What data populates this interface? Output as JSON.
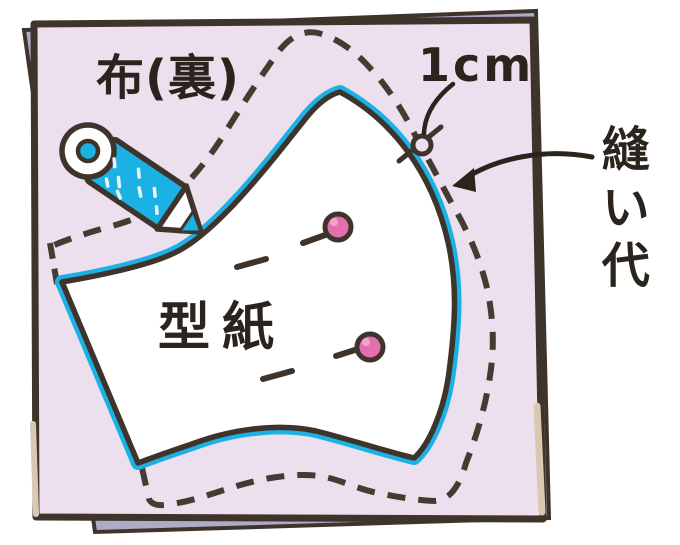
{
  "illustration": {
    "title": "mask sewing pattern diagram",
    "labels": {
      "fabric": "布(裏)",
      "seam_width": "1cm",
      "seam_allowance": "縫い代",
      "pattern": "型紙"
    },
    "colors": {
      "fabric": "#ecdfee",
      "fabric_under_layer": "#aeabc8",
      "fabric_edge_beige": "#d9c9b2",
      "outline": "#3e342c",
      "dash_line": "#453b31",
      "trace_line": "#1cb1e5",
      "pencil_body": "#1cb1e5",
      "pin_head": "#e56fae",
      "pin_highlight": "#f2a3cc",
      "pattern_paper": "#ffffff",
      "text": "#2b241d"
    }
  }
}
